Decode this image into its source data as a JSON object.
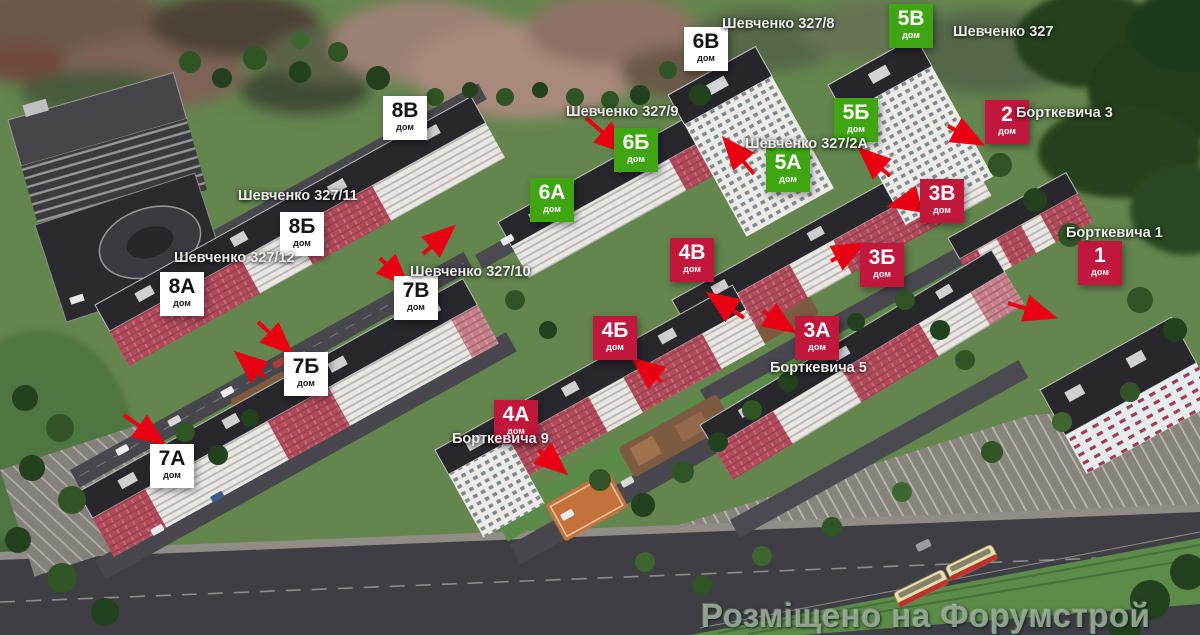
{
  "watermark": "Розміщено на Форумстрой",
  "palette": {
    "marker_green": "#3fa513",
    "marker_crimson": "#c2173d",
    "marker_white": "#ffffff",
    "arrow_red": "#e80013"
  },
  "building_labels": [
    {
      "code": "5В",
      "sub": "дом",
      "variant": "green",
      "x": 889,
      "y": 4
    },
    {
      "code": "6В",
      "sub": "дом",
      "variant": "white",
      "x": 684,
      "y": 27
    },
    {
      "code": "8В",
      "sub": "дом",
      "variant": "white",
      "x": 383,
      "y": 96
    },
    {
      "code": "5Б",
      "sub": "дом",
      "variant": "green",
      "x": 834,
      "y": 98
    },
    {
      "code": "2",
      "sub": "дом",
      "variant": "crimson",
      "x": 985,
      "y": 100
    },
    {
      "code": "6Б",
      "sub": "дом",
      "variant": "green",
      "x": 614,
      "y": 128
    },
    {
      "code": "5А",
      "sub": "дом",
      "variant": "green",
      "x": 766,
      "y": 148
    },
    {
      "code": "6А",
      "sub": "дом",
      "variant": "green",
      "x": 530,
      "y": 178
    },
    {
      "code": "3В",
      "sub": "дом",
      "variant": "crimson",
      "x": 920,
      "y": 179
    },
    {
      "code": "8Б",
      "sub": "дом",
      "variant": "white",
      "x": 280,
      "y": 212
    },
    {
      "code": "4В",
      "sub": "дом",
      "variant": "crimson",
      "x": 670,
      "y": 238
    },
    {
      "code": "1",
      "sub": "дом",
      "variant": "crimson",
      "x": 1078,
      "y": 241
    },
    {
      "code": "3Б",
      "sub": "дом",
      "variant": "crimson",
      "x": 860,
      "y": 243
    },
    {
      "code": "8А",
      "sub": "дом",
      "variant": "white",
      "x": 160,
      "y": 272
    },
    {
      "code": "7В",
      "sub": "дом",
      "variant": "white",
      "x": 394,
      "y": 276
    },
    {
      "code": "4Б",
      "sub": "дом",
      "variant": "crimson",
      "x": 593,
      "y": 316
    },
    {
      "code": "3А",
      "sub": "дом",
      "variant": "crimson",
      "x": 795,
      "y": 316
    },
    {
      "code": "7Б",
      "sub": "дом",
      "variant": "white",
      "x": 284,
      "y": 352
    },
    {
      "code": "4А",
      "sub": "дом",
      "variant": "crimson",
      "x": 494,
      "y": 400
    },
    {
      "code": "7А",
      "sub": "дом",
      "variant": "white",
      "x": 150,
      "y": 444
    }
  ],
  "street_labels": [
    {
      "text": "Шевченко 327/8",
      "x": 722,
      "y": 16
    },
    {
      "text": "Шевченко 327",
      "x": 953,
      "y": 24
    },
    {
      "text": "Шевченко 327/9",
      "x": 566,
      "y": 104
    },
    {
      "text": "Борткевича 3",
      "x": 1016,
      "y": 105
    },
    {
      "text": "Шевченко 327/2А",
      "x": 745,
      "y": 136
    },
    {
      "text": "Шевченко 327/11",
      "x": 238,
      "y": 188
    },
    {
      "text": "Борткевича 1",
      "x": 1066,
      "y": 225
    },
    {
      "text": "Шевченко 327/12",
      "x": 174,
      "y": 250
    },
    {
      "text": "Шевченко 327/10",
      "x": 410,
      "y": 264
    },
    {
      "text": "Борткевича 5",
      "x": 770,
      "y": 360
    },
    {
      "text": "Борткевича 9",
      "x": 452,
      "y": 431
    }
  ],
  "arrows": [
    [
      124,
      415,
      160,
      441
    ],
    [
      258,
      322,
      288,
      350
    ],
    [
      265,
      377,
      240,
      356
    ],
    [
      380,
      258,
      404,
      282
    ],
    [
      423,
      254,
      450,
      230
    ],
    [
      586,
      118,
      622,
      149
    ],
    [
      754,
      174,
      727,
      142
    ],
    [
      890,
      176,
      863,
      152
    ],
    [
      915,
      200,
      894,
      205
    ],
    [
      948,
      126,
      978,
      142
    ],
    [
      1008,
      303,
      1050,
      316
    ],
    [
      831,
      261,
      859,
      246
    ],
    [
      744,
      318,
      712,
      296
    ],
    [
      763,
      311,
      790,
      329
    ],
    [
      662,
      382,
      637,
      362
    ],
    [
      539,
      450,
      562,
      470
    ]
  ]
}
